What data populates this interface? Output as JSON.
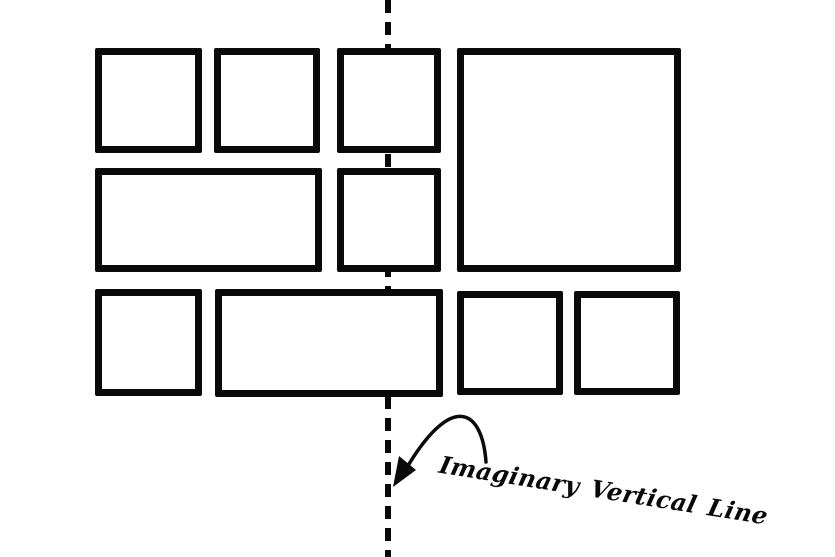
{
  "diagram": {
    "label": {
      "text": "Imaginary Vertical Line"
    },
    "colors": {
      "stroke": "#0a0a0a",
      "background": "#ffffff"
    },
    "vertical_line": {
      "orientation": "vertical",
      "style": "dashed",
      "x": 385,
      "thickness": 6,
      "dash_length": 13,
      "gap_length": 9
    },
    "border_width": 7,
    "boxes": [
      {
        "id": "row1-box-1",
        "x": 95,
        "y": 48,
        "w": 107,
        "h": 105
      },
      {
        "id": "row1-box-2",
        "x": 214,
        "y": 48,
        "w": 106,
        "h": 105
      },
      {
        "id": "row1-box-3",
        "x": 337,
        "y": 48,
        "w": 104,
        "h": 105
      },
      {
        "id": "right-large-box",
        "x": 457,
        "y": 48,
        "w": 224,
        "h": 224
      },
      {
        "id": "row2-wide-box",
        "x": 95,
        "y": 168,
        "w": 227,
        "h": 104
      },
      {
        "id": "row2-box-2",
        "x": 337,
        "y": 168,
        "w": 104,
        "h": 104
      },
      {
        "id": "row3-box-1",
        "x": 95,
        "y": 289,
        "w": 107,
        "h": 107
      },
      {
        "id": "row3-wide-box",
        "x": 215,
        "y": 289,
        "w": 228,
        "h": 108
      },
      {
        "id": "row3-box-3",
        "x": 457,
        "y": 291,
        "w": 106,
        "h": 104
      },
      {
        "id": "row3-box-4",
        "x": 574,
        "y": 291,
        "w": 106,
        "h": 104
      }
    ],
    "arrow": {
      "tail": [
        486,
        462
      ],
      "tip": [
        394,
        486
      ],
      "curve": "M 486 462 C 482 408 452 394 409 464",
      "head_points": "393,487 416,470 399,456"
    }
  }
}
